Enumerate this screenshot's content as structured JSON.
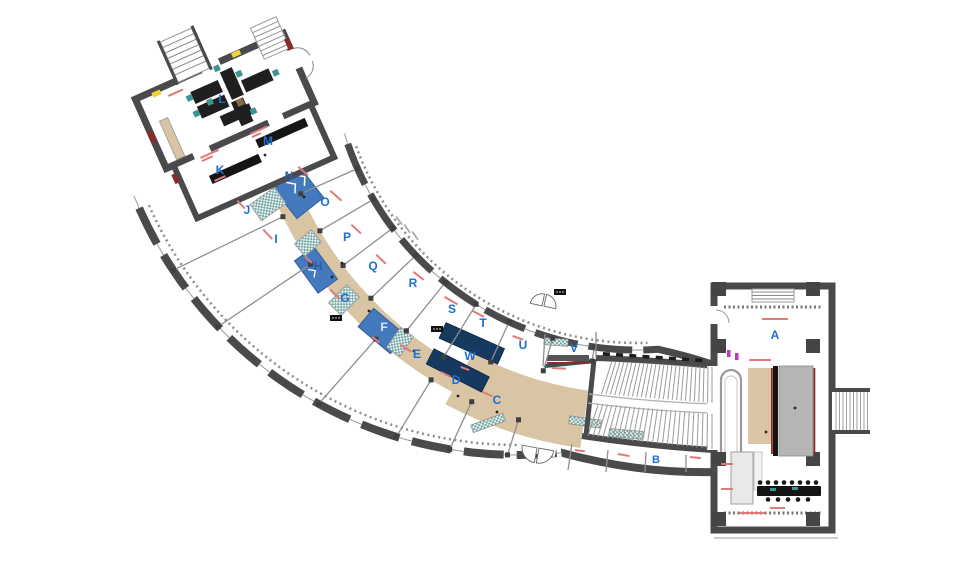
{
  "image": {
    "width": 969,
    "height": 570,
    "background": "#ffffff",
    "description": "Architectural floor plan: curved gallery wing with lettered rooms, amphitheater stair link and rectangular east hall"
  },
  "colors": {
    "wall": "#4a4a4c",
    "partition": "#8f8f8f",
    "corridor_tan": "#d9c4a4",
    "ramp_blue": "#4579bd",
    "ramp_blue_dark": "#2f5e9e",
    "navy_table": "#16395f",
    "teal": "#3d9494",
    "stage_grey": "#b5b5b5",
    "stair_fill": "#e9e9e7",
    "room_letter": "#1a6fd0",
    "letter_on_ramp": "#2b5ca8",
    "letter_light": "#dce9f8",
    "annotation_red": "#e07a7a",
    "accent_dark_red": "#8a2a2a",
    "accent_yellow": "#f0d03c",
    "accent_magenta": "#c036c0"
  },
  "rooms": [
    {
      "id": "A",
      "x": 775,
      "y": 339
    },
    {
      "id": "B",
      "x": 656,
      "y": 463,
      "size": 11
    },
    {
      "id": "C",
      "x": 497,
      "y": 404
    },
    {
      "id": "D",
      "x": 456,
      "y": 384
    },
    {
      "id": "E",
      "x": 417,
      "y": 358
    },
    {
      "id": "F",
      "x": 384,
      "y": 331,
      "fill": "letter_light"
    },
    {
      "id": "G",
      "x": 345,
      "y": 302
    },
    {
      "id": "H",
      "x": 318,
      "y": 270,
      "fill": "letter_on_ramp"
    },
    {
      "id": "I",
      "x": 276,
      "y": 243
    },
    {
      "id": "J",
      "x": 247,
      "y": 214
    },
    {
      "id": "K",
      "x": 220,
      "y": 174
    },
    {
      "id": "L",
      "x": 222,
      "y": 103
    },
    {
      "id": "M",
      "x": 268,
      "y": 145
    },
    {
      "id": "N",
      "x": 289,
      "y": 180,
      "fill": "letter_on_ramp"
    },
    {
      "id": "O",
      "x": 325,
      "y": 206
    },
    {
      "id": "P",
      "x": 347,
      "y": 241
    },
    {
      "id": "Q",
      "x": 373,
      "y": 270
    },
    {
      "id": "R",
      "x": 413,
      "y": 287
    },
    {
      "id": "S",
      "x": 452,
      "y": 313
    },
    {
      "id": "T",
      "x": 483,
      "y": 327
    },
    {
      "id": "U",
      "x": 523,
      "y": 349
    },
    {
      "id": "V",
      "x": 574,
      "y": 352
    },
    {
      "id": "W",
      "x": 470,
      "y": 360
    }
  ],
  "annotations": {
    "red_marks": [
      [
        168,
        95,
        -24,
        16
      ],
      [
        250,
        133,
        -24,
        18,
        10
      ],
      [
        200,
        157,
        -24,
        20,
        12
      ],
      [
        214,
        180,
        -24,
        12
      ],
      [
        299,
        166,
        42,
        13
      ],
      [
        331,
        190,
        42,
        15
      ],
      [
        352,
        224,
        42,
        13
      ],
      [
        377,
        254,
        44,
        13
      ],
      [
        414,
        271,
        38,
        13
      ],
      [
        445,
        296,
        30,
        15
      ],
      [
        473,
        310,
        28,
        13
      ],
      [
        513,
        335,
        20,
        11
      ],
      [
        238,
        200,
        46,
        11
      ],
      [
        264,
        229,
        46,
        13
      ],
      [
        331,
        289,
        44,
        13
      ],
      [
        401,
        344,
        32,
        13
      ],
      [
        441,
        371,
        26,
        11
      ],
      [
        483,
        391,
        24,
        11
      ],
      [
        461,
        366,
        20,
        9
      ],
      [
        373,
        336,
        40,
        9
      ],
      [
        306,
        256,
        44,
        9
      ],
      [
        575,
        449,
        8,
        10
      ],
      [
        618,
        453,
        10,
        12
      ],
      [
        690,
        456,
        6,
        11
      ],
      [
        762,
        318,
        0,
        26
      ],
      [
        749,
        359,
        0,
        22
      ],
      [
        721,
        463,
        0,
        12
      ],
      [
        721,
        488,
        0,
        12
      ],
      [
        739,
        512,
        0,
        26
      ],
      [
        770,
        507,
        0,
        15
      ],
      [
        552,
        367,
        3,
        14
      ]
    ],
    "grey_dimension_marks": [
      [
        397,
        216,
        55
      ],
      [
        405,
        224,
        55
      ],
      [
        413,
        231,
        55
      ]
    ],
    "door_tags": [
      [
        437,
        329
      ],
      [
        560,
        292
      ],
      [
        336,
        318
      ]
    ],
    "black_dots": [
      [
        227,
        117
      ],
      [
        265,
        155
      ],
      [
        304,
        197
      ],
      [
        342,
        263
      ],
      [
        414,
        351
      ],
      [
        458,
        396
      ],
      [
        497,
        412
      ],
      [
        795,
        408
      ],
      [
        766,
        432
      ],
      [
        369,
        311
      ],
      [
        332,
        277
      ]
    ]
  }
}
